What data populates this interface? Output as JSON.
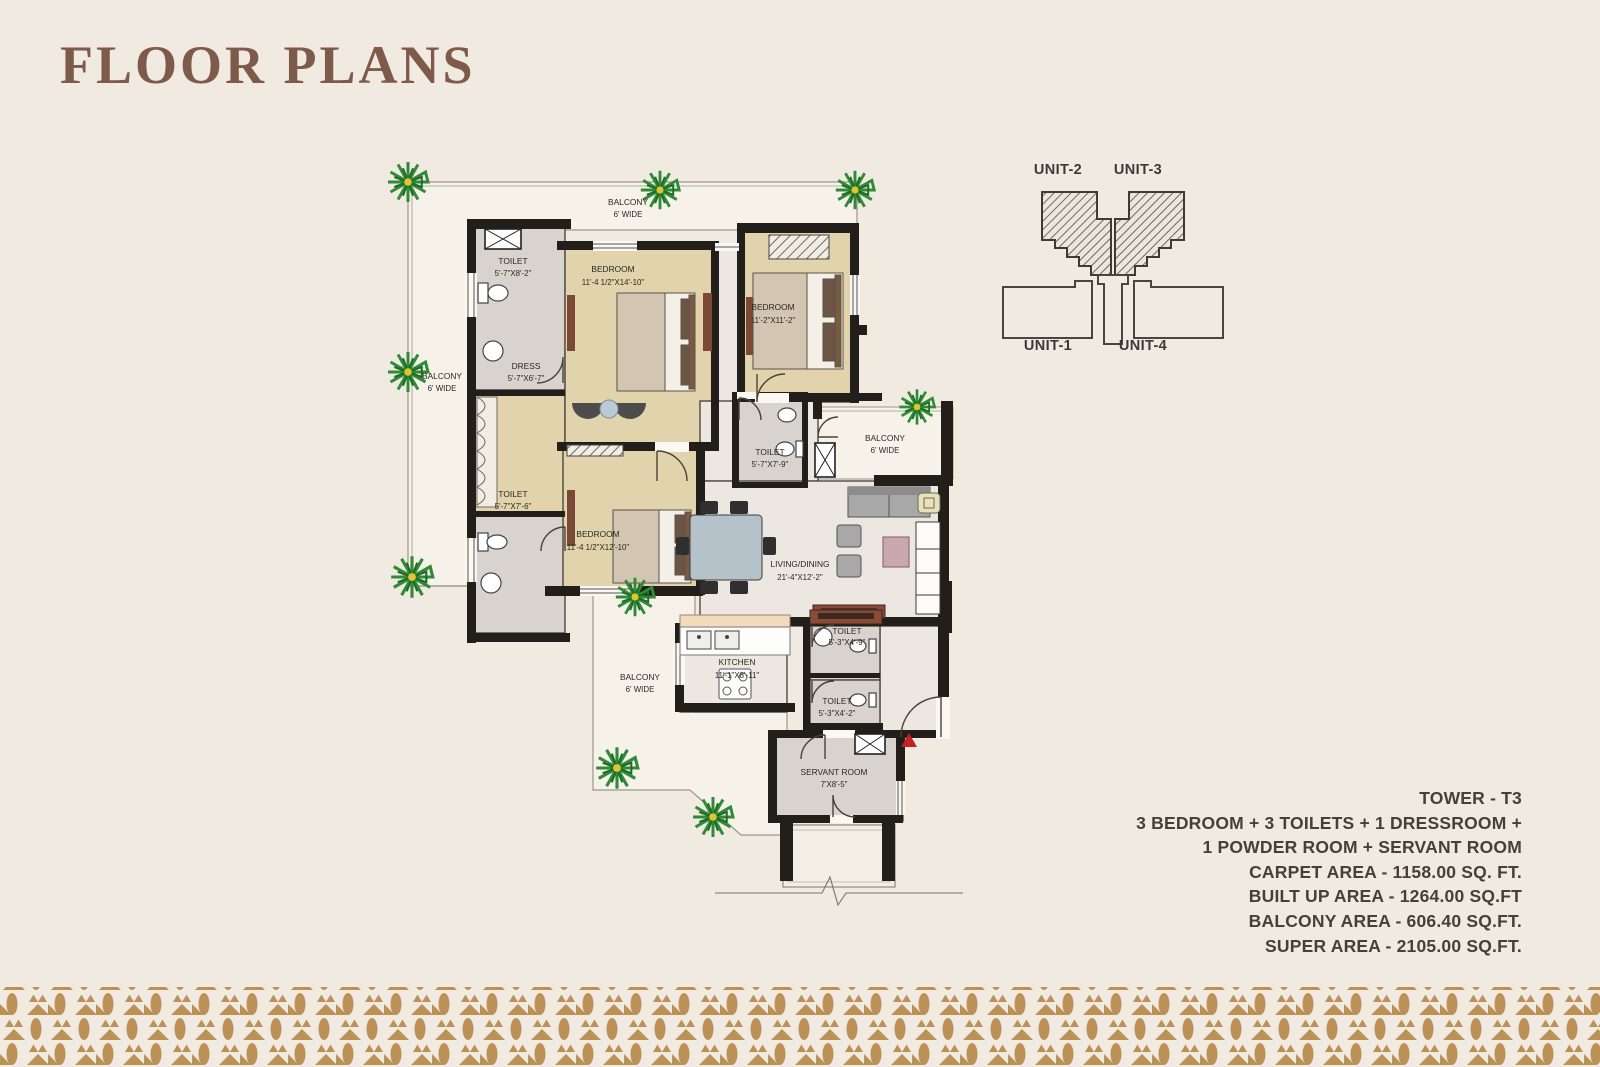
{
  "page": {
    "title": "FLOOR PLANS"
  },
  "key_diagram": {
    "unit_top_left": "UNIT-2",
    "unit_top_right": "UNIT-3",
    "unit_bottom_left": "UNIT-1",
    "unit_bottom_right": "UNIT-4"
  },
  "plan": {
    "balcony": {
      "label": "BALCONY",
      "width": "6' WIDE"
    },
    "rooms": [
      {
        "name": "TOILET",
        "dims": "5'-7\"X8'-2\""
      },
      {
        "name": "BEDROOM",
        "dims": "11'-4 1/2\"X14'-10\""
      },
      {
        "name": "BEDROOM",
        "dims": "11'-2\"X11'-2\""
      },
      {
        "name": "DRESS",
        "dims": "5'-7\"X6'-7\""
      },
      {
        "name": "TOILET",
        "dims": "5'-7\"X7'-6\""
      },
      {
        "name": "BEDROOM",
        "dims": "11'-4 1/2\"X12'-10\""
      },
      {
        "name": "TOILET",
        "dims": "5'-7\"X7'-9\""
      },
      {
        "name": "LIVING/DINING",
        "dims": "21'-4\"X12'-2\""
      },
      {
        "name": "KITCHEN",
        "dims": "11'-1\"X8'-11\""
      },
      {
        "name": "TOILET",
        "dims": "5'-3\"X4'-9\""
      },
      {
        "name": "TOILET",
        "dims": "5'-3\"X4'-2\""
      },
      {
        "name": "SERVANT ROOM",
        "dims": "7'X8'-5\""
      }
    ]
  },
  "specs": {
    "tower": "TOWER - T3",
    "config_line1": "3 BEDROOM + 3 TOILETS + 1 DRESSROOM +",
    "config_line2": "1 POWDER ROOM + SERVANT ROOM",
    "carpet_area": "CARPET AREA - 1158.00 SQ. FT.",
    "built_up_area": "BUILT UP AREA - 1264.00 SQ.FT",
    "balcony_area": "BALCONY AREA - 606.40 SQ.FT.",
    "super_area": "SUPER AREA - 2105.00 SQ.FT."
  },
  "colors": {
    "background": "#f1eae1",
    "title": "#7d5a49",
    "walls": "#221e1a",
    "room_tan": "#e1d3ab",
    "room_marble": "#d8d3cf",
    "room_light": "#ece7e0",
    "accent_gold": "#bb9155",
    "palm_green": "#2f8b35",
    "entry_marker_red": "#c32222",
    "wood": "#7b4935"
  }
}
